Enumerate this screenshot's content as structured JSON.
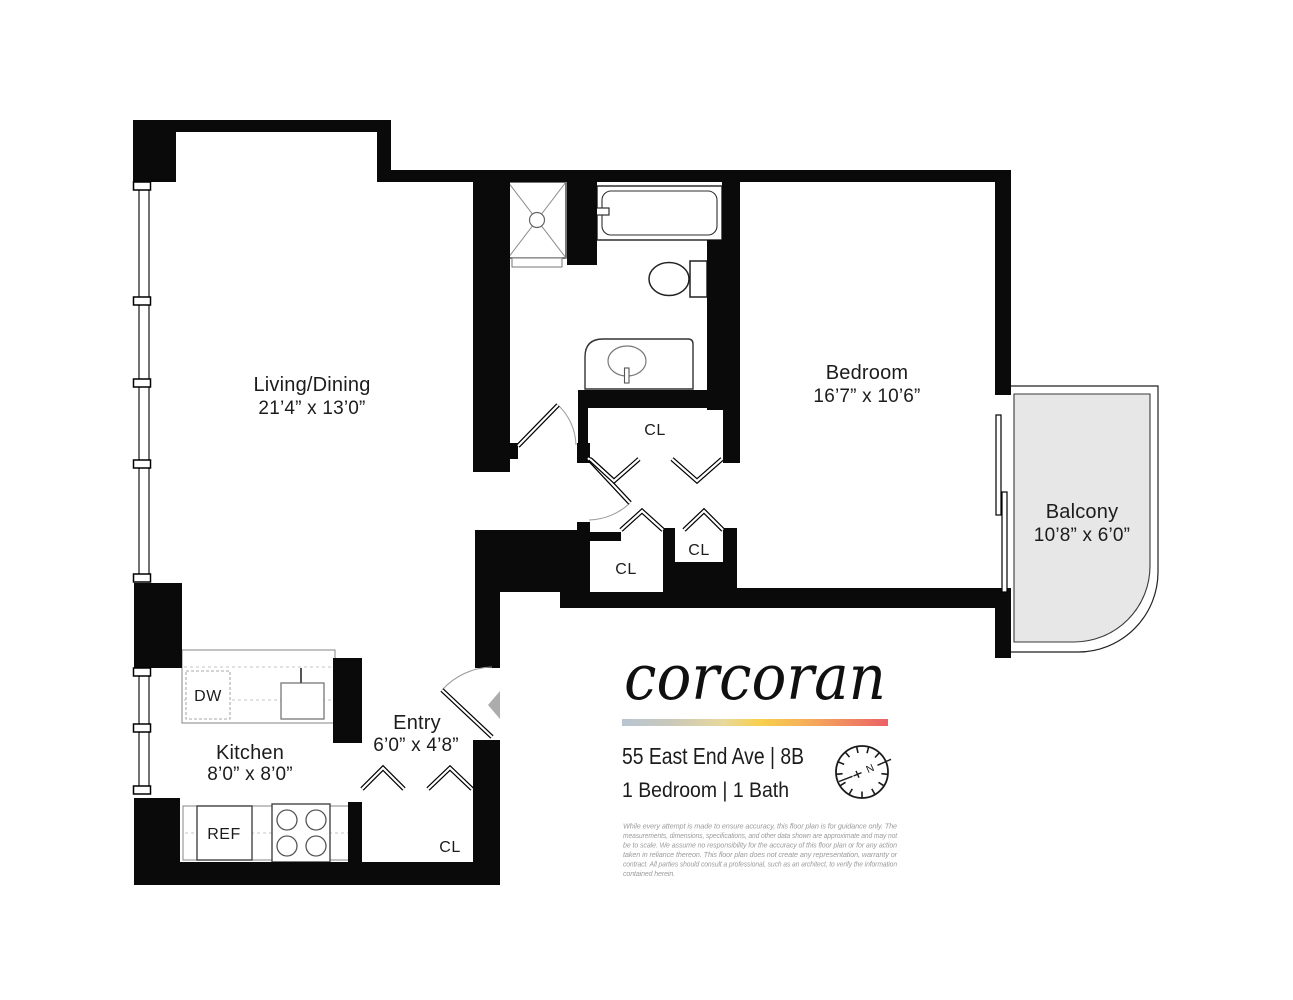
{
  "plan": {
    "rooms": {
      "living": {
        "name": "Living/Dining",
        "dims": "21’4” x 13’0”"
      },
      "bedroom": {
        "name": "Bedroom",
        "dims": "16’7” x 10’6”"
      },
      "balcony": {
        "name": "Balcony",
        "dims": "10’8” x 6’0”"
      },
      "kitchen": {
        "name": "Kitchen",
        "dims": "8’0” x 8’0”"
      },
      "entry": {
        "name": "Entry",
        "dims": "6’0” x 4’8”"
      }
    },
    "closets": {
      "hall_top": "CL",
      "hall_left": "CL",
      "hall_right": "CL",
      "entry_closet": "CL"
    },
    "appliances": {
      "dishwasher": "DW",
      "refrigerator": "REF"
    }
  },
  "branding": {
    "logo": "corcoran",
    "address": "55 East End Ave | 8B",
    "unit_info": "1 Bedroom | 1 Bath",
    "compass_north": "N",
    "gradient_colors": [
      "#b7c5d3",
      "#c9c8bb",
      "#e8d89c",
      "#f7d04c",
      "#f6b159",
      "#f08a60",
      "#ec6166"
    ],
    "wall_color": "#0a0a0a",
    "balcony_fill": "#e7e7e7"
  },
  "disclaimer": {
    "lines": [
      "While every attempt is made to ensure accuracy, this floor plan is for guidance only. The",
      "measurements, dimensions, specifications, and other data shown are approximate and may not",
      "be to scale. We assume no responsibility for the accuracy of this floor plan or for any action",
      "taken in reliance thereon. This floor plan does not create any representation, warranty or",
      "contract. All parties should consult a professional, such as an architect, to verify the information",
      "contained herein."
    ]
  }
}
